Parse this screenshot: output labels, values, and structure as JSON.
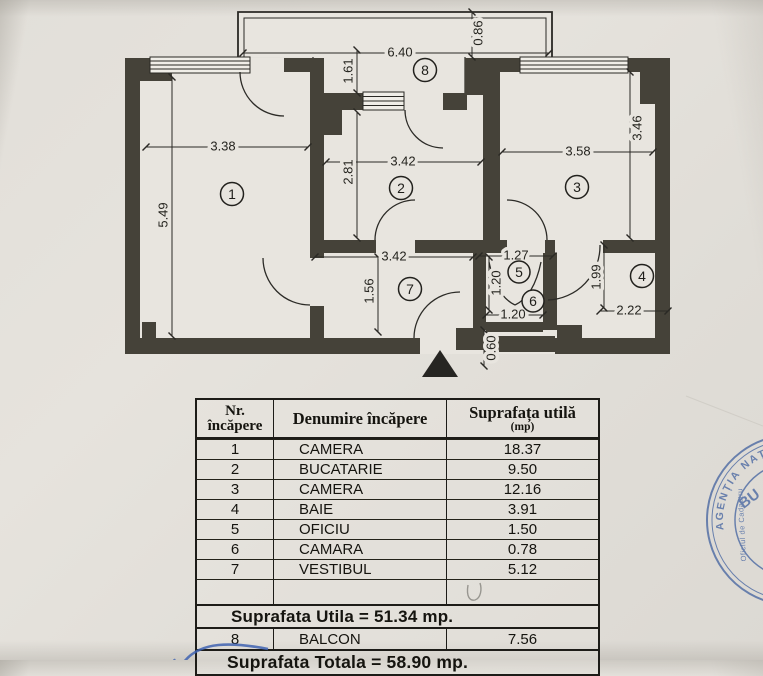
{
  "plan": {
    "rooms": [
      "1",
      "2",
      "3",
      "4",
      "5",
      "6",
      "7",
      "8"
    ],
    "dims": {
      "balcony_width": "6.40",
      "balcony_rail": "0.86",
      "balcony_depth": "1.61",
      "room1_w": "3.38",
      "room1_h": "5.49",
      "room2_w": "3.42",
      "room2_h": "2.81",
      "room3_w": "3.58",
      "room3_h": "3.46",
      "room7_w": "3.42",
      "room7_h": "1.56",
      "room5_w": "1.27",
      "room5_h": "1.20",
      "room6_w": "1.20",
      "room4_w": "2.22",
      "room4_h": "1.99",
      "entry_recess": "0.60"
    },
    "symbols": {
      "entrance_marker": "triangle-up",
      "window_symbol": "hatched-lines",
      "door_symbol": "quarter-arc"
    }
  },
  "table": {
    "header": {
      "col1_line1": "Nr.",
      "col1_line2": "încăpere",
      "col2": "Denumire încăpere",
      "col3_line1": "Suprafața utilă",
      "col3_line2": "(mp)"
    },
    "rows": [
      {
        "nr": "1",
        "name": "CAMERA",
        "area": "18.37"
      },
      {
        "nr": "2",
        "name": "BUCATARIE",
        "area": "9.50"
      },
      {
        "nr": "3",
        "name": "CAMERA",
        "area": "12.16"
      },
      {
        "nr": "4",
        "name": "BAIE",
        "area": "3.91"
      },
      {
        "nr": "5",
        "name": "OFICIU",
        "area": "1.50"
      },
      {
        "nr": "6",
        "name": "CAMARA",
        "area": "0.78"
      },
      {
        "nr": "7",
        "name": "VESTIBUL",
        "area": "5.12"
      }
    ],
    "subtotal": "Suprafata Utila = 51.34 mp.",
    "balcon_row": {
      "nr": "8",
      "name": "BALCON",
      "area": "7.56"
    },
    "total": "Suprafata Totala = 58.90 mp."
  },
  "stamp": {
    "ring_text": "AGENȚIA NAȚIONALĂ DE CADASTRU",
    "center_text": "BU",
    "office_text": "Oficiul de Cadastru"
  },
  "colors": {
    "stamp_blue": "#5470a6",
    "pen_blue": "#3f63b2",
    "wall_dark": "#454239"
  }
}
